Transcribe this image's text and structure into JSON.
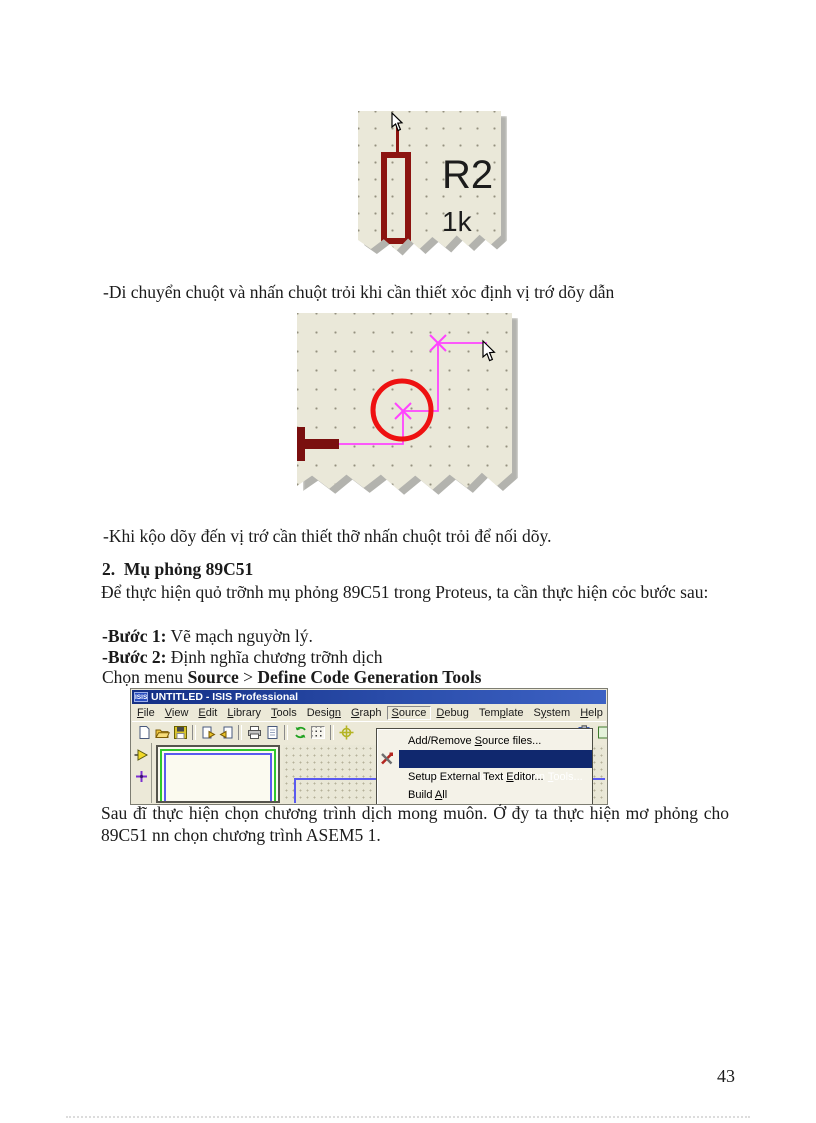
{
  "page": {
    "number": "43"
  },
  "fig_resistor": {
    "ref": "R2",
    "value": "1k"
  },
  "text": {
    "move_line": "-Di chuyển chuột và nhấn chuột trỏi khi cần thiết xỏc định vị trớ dõy dẫn",
    "drag_line": "-Khi kộo dõy đến vị trớ cần thiết thỡ nhấn chuột trỏi để nối dõy.",
    "heading": "2.  Mụ phỏng 89C51",
    "intro": "Để thực hiện quỏ trỡnh mụ phỏng 89C51 trong Proteus, ta cần thực hiện cỏc bước sau:",
    "step1_label": "-Bước 1:",
    "step1_text": " Vẽ mạch nguyờn lý.",
    "step2_label": "-Bước 2:",
    "step2_text": " Định nghĩa chương trỡnh dịch",
    "menu_prefix": "Chọn menu ",
    "menu_source": "Source",
    "menu_sep": " > ",
    "menu_item": "Define Code Generation Tools",
    "closing": "Sau đĩ thực hiện chọn chương trình dịch mong muôn. Ở đy ta thực hiện mơ phỏng cho 89C51 nn chọn chương trình ASEM5 1."
  },
  "isis_window": {
    "title": "UNTITLED - ISIS Professional",
    "logo": "ISIS",
    "menus": [
      {
        "pre": "",
        "u": "F",
        "post": "ile"
      },
      {
        "pre": "",
        "u": "V",
        "post": "iew"
      },
      {
        "pre": "",
        "u": "E",
        "post": "dit"
      },
      {
        "pre": "",
        "u": "L",
        "post": "ibrary"
      },
      {
        "pre": "",
        "u": "T",
        "post": "ools"
      },
      {
        "pre": "Desig",
        "u": "n",
        "post": ""
      },
      {
        "pre": "",
        "u": "G",
        "post": "raph"
      },
      {
        "pre": "",
        "u": "S",
        "post": "ource"
      },
      {
        "pre": "",
        "u": "D",
        "post": "ebug"
      },
      {
        "pre": "Tem",
        "u": "p",
        "post": "late"
      },
      {
        "pre": "S",
        "u": "y",
        "post": "stem"
      },
      {
        "pre": "",
        "u": "H",
        "post": "elp"
      }
    ],
    "popup_items": [
      {
        "pre": "Add/Remove ",
        "u": "S",
        "post": "ource files..."
      },
      {
        "pre": "Define Code Generation ",
        "u": "T",
        "post": "ools..."
      },
      {
        "pre": "Setup External Text ",
        "u": "E",
        "post": "ditor..."
      },
      {
        "pre": "Build ",
        "u": "A",
        "post": "ll"
      }
    ],
    "colors": {
      "titlebar": "#1d3a8f",
      "chrome": "#ece9d8",
      "highlight": "#10286e",
      "paper": "#eae8d9",
      "wire_magenta": "#ff44ff",
      "component_red": "#8c1410",
      "circle_red": "#ee1111"
    }
  }
}
